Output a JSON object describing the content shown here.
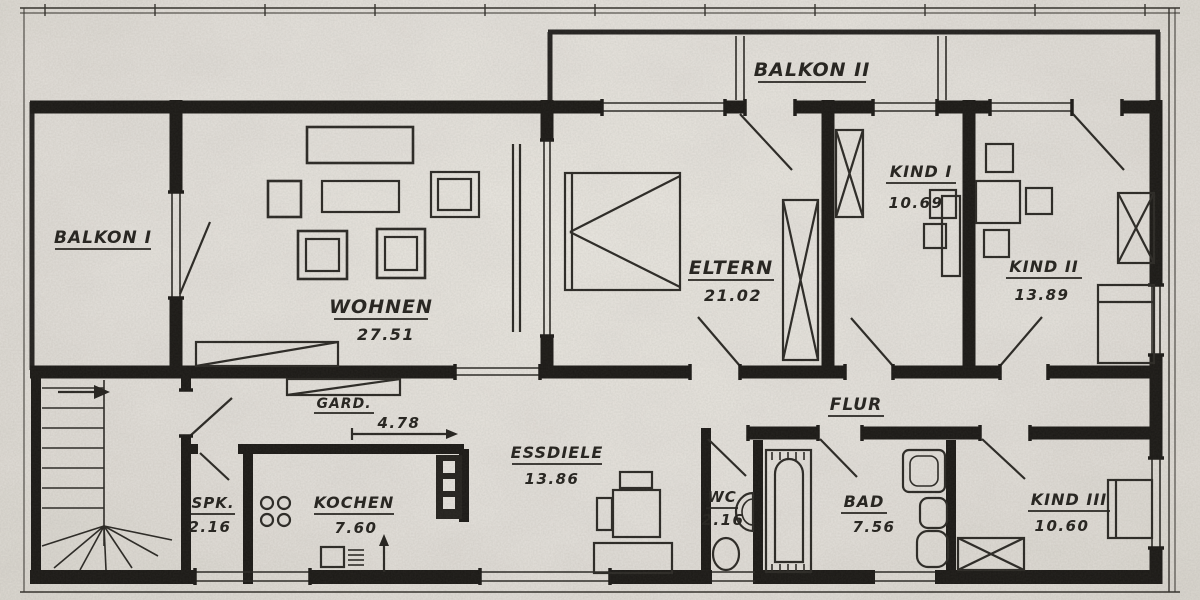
{
  "drawing": {
    "kind": "apartment floor plan, scanned blueprint"
  },
  "colors": {
    "paper": "#e7e4de",
    "ink": "#1b1916"
  },
  "rooms": {
    "balkon1": {
      "label": "BALKON I"
    },
    "balkon2": {
      "label": "BALKON II"
    },
    "wohnen": {
      "label": "WOHNEN",
      "area": "27.51"
    },
    "eltern": {
      "label": "ELTERN",
      "area": "21.02"
    },
    "kind1": {
      "label": "KIND I",
      "area": "10.69"
    },
    "kind2": {
      "label": "KIND II",
      "area": "13.89"
    },
    "kind3": {
      "label": "KIND III",
      "area": "10.60"
    },
    "flur": {
      "label": "FLUR"
    },
    "essdiele": {
      "label": "ESSDIELE",
      "area": "13.86"
    },
    "gard": {
      "label": "GARD.",
      "dimension": "4.78"
    },
    "spk": {
      "label": "SPK.",
      "area": "2.16"
    },
    "kochen": {
      "label": "KOCHEN",
      "area": "7.60"
    },
    "wc": {
      "label": "WC",
      "area": "2.16"
    },
    "bad": {
      "label": "BAD",
      "area": "7.56"
    }
  }
}
